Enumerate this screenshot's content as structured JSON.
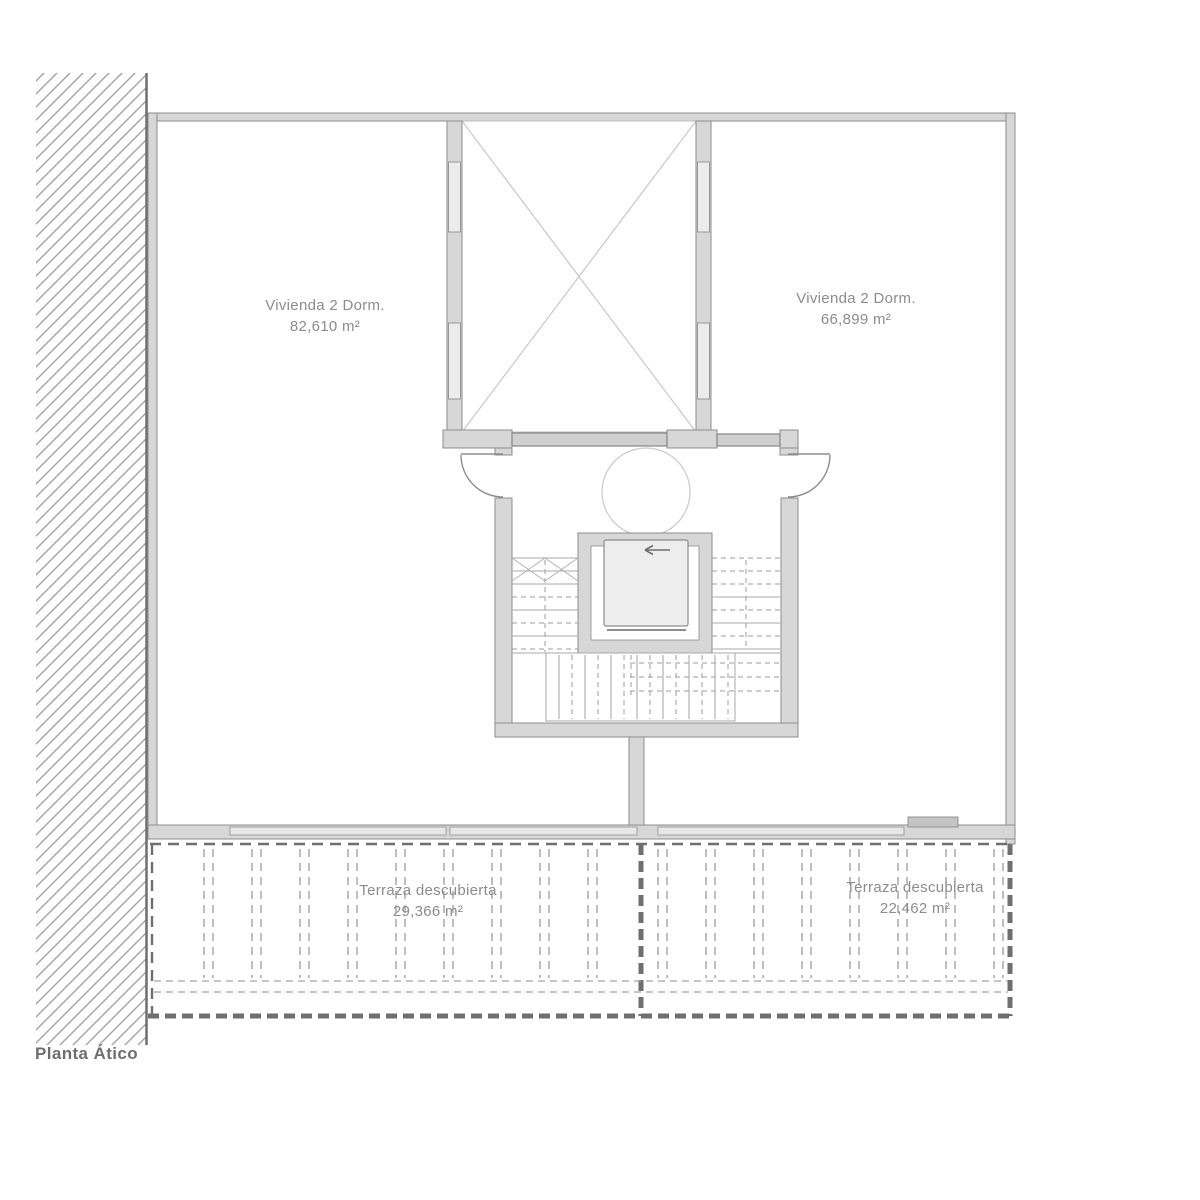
{
  "plan": {
    "title": "Planta Ático",
    "apartment_left": {
      "name": "Vivienda 2 Dorm.",
      "area": "82,610 m²"
    },
    "apartment_right": {
      "name": "Vivienda 2 Dorm.",
      "area": "66,899 m²"
    },
    "terrace_left": {
      "name": "Terraza descubierta",
      "area": "29,366 m²"
    },
    "terrace_right": {
      "name": "Terraza descubierta",
      "area": "22,462 m²"
    },
    "colors": {
      "wall_fill": "#d7d7d7",
      "wall_stroke": "#8d8d8d",
      "stair_line": "#a8a8a8",
      "terrace_dash_dark": "#6f6f6f",
      "terrace_dash_light": "#9b9b9b",
      "label_text": "#8c8c8c",
      "title_text": "#6e6e6e",
      "background": "#ffffff"
    }
  }
}
